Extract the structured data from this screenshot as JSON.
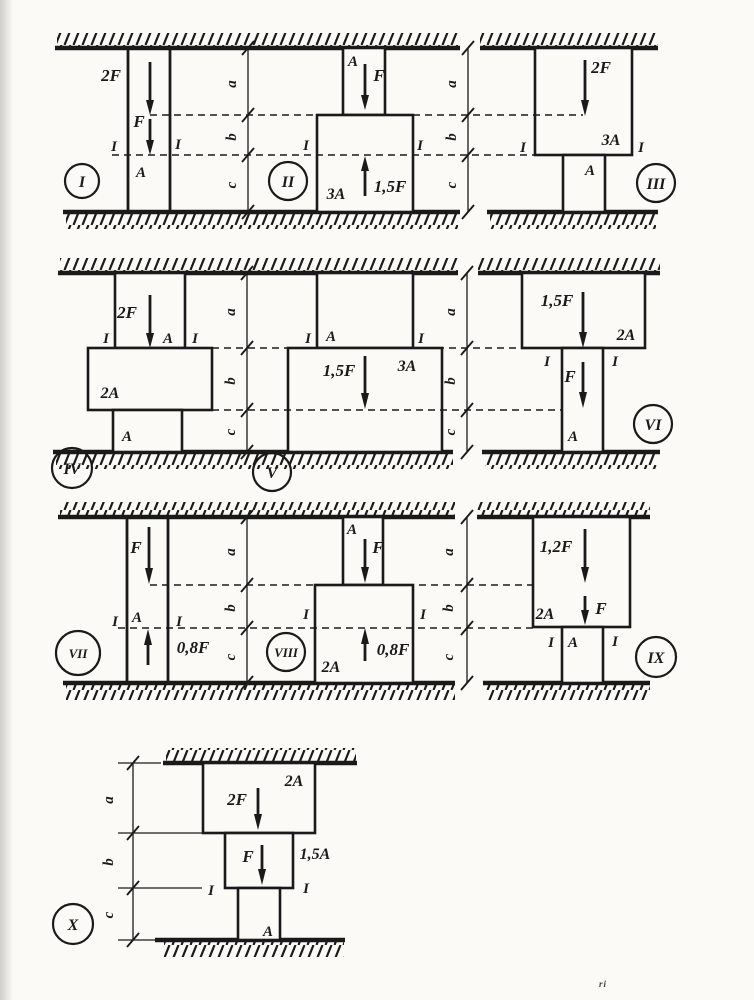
{
  "dim_labels": {
    "a": "a",
    "b": "b",
    "c": "c"
  },
  "artifact": "ri",
  "diagrams": {
    "d1": {
      "roman": "I",
      "force_top": "2F",
      "force_mid": "F",
      "section": "I",
      "area_main": "A"
    },
    "d2": {
      "roman": "II",
      "area_top": "A",
      "force_top": "F",
      "force_up": "1,5F",
      "section": "I",
      "area_main": "3A"
    },
    "d3": {
      "roman": "III",
      "force_top": "2F",
      "area_top": "3A",
      "section": "I",
      "area_bottom": "A"
    },
    "d4": {
      "roman": "IV",
      "force_top": "2F",
      "area_top": "A",
      "section": "I",
      "area_mid": "2A",
      "area_bottom": "A"
    },
    "d5": {
      "roman": "V",
      "area_top": "A",
      "section": "I",
      "force_mid": "1,5F",
      "area_main": "3A"
    },
    "d6": {
      "roman": "VI",
      "force_top": "1,5F",
      "area_top": "2A",
      "section": "I",
      "force_mid": "F",
      "area_bottom": "A"
    },
    "d7": {
      "roman": "VII",
      "force_top": "F",
      "section": "I",
      "area_main": "A",
      "force_up": "0,8F"
    },
    "d8": {
      "roman": "VIII",
      "area_top": "A",
      "force_top": "F",
      "section": "I",
      "force_up": "0,8F",
      "area_main": "2A"
    },
    "d9": {
      "roman": "IX",
      "force_top": "1,2F",
      "force_mid": "F",
      "area_top": "2A",
      "section": "I",
      "area_bottom": "A"
    },
    "d10": {
      "roman": "X",
      "area_top": "2A",
      "force_top": "2F",
      "force_mid": "F",
      "area_mid": "1,5A",
      "section": "I",
      "area_bottom": "A"
    }
  }
}
